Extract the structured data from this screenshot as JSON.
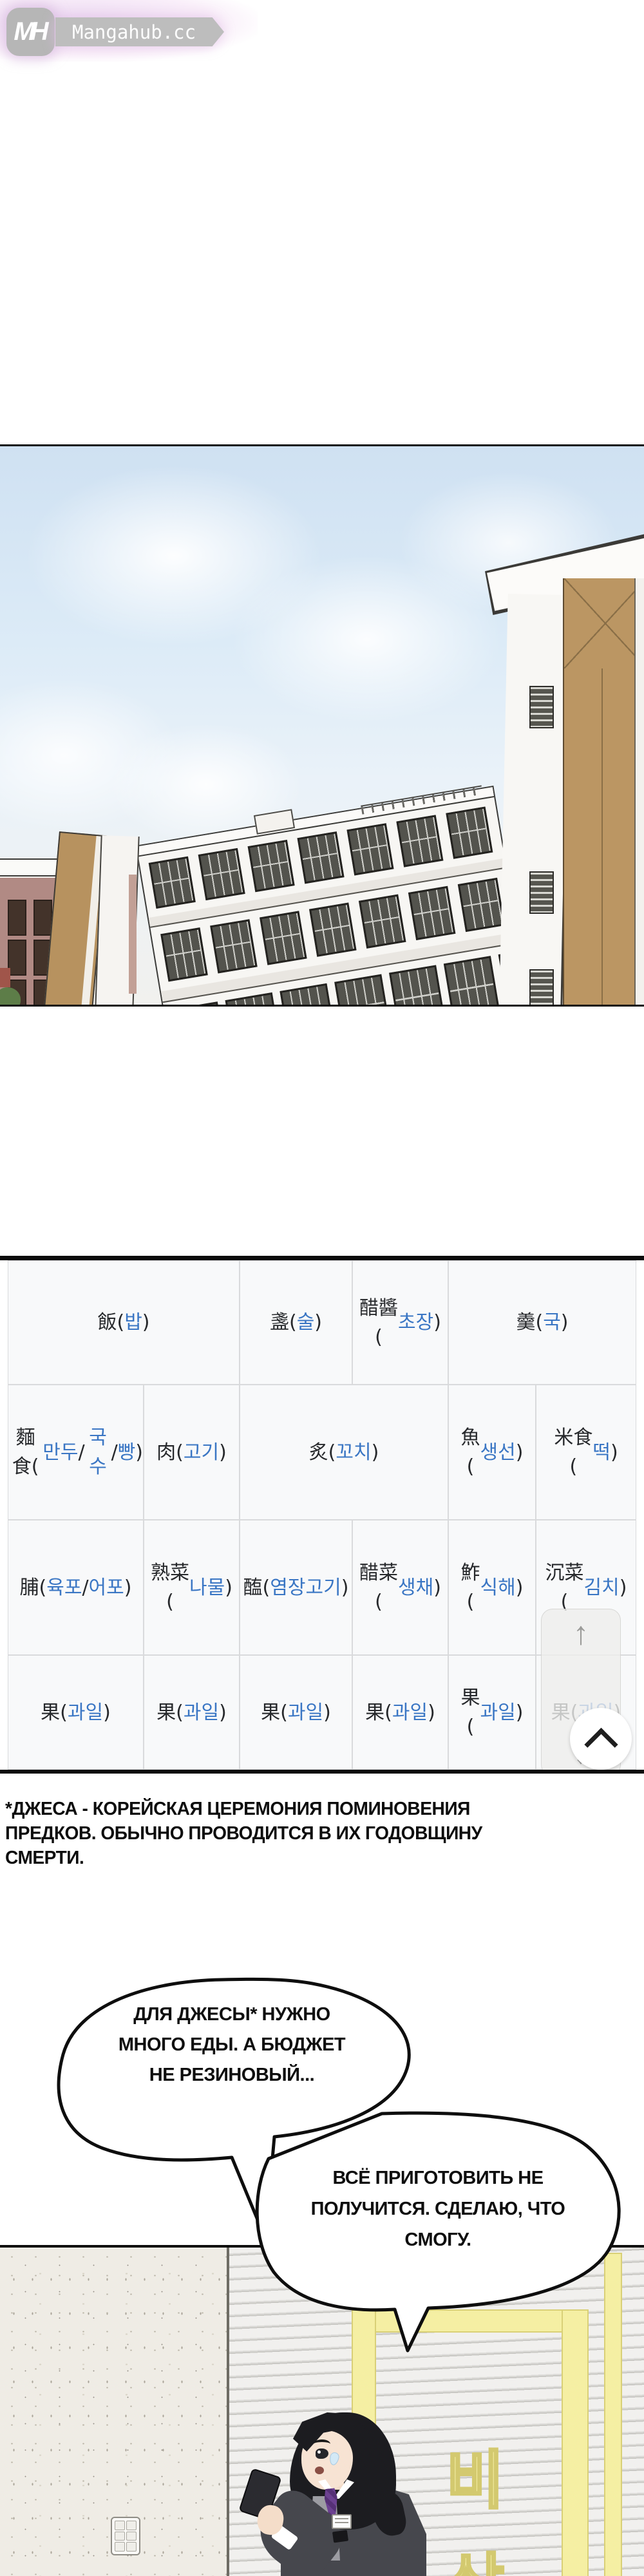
{
  "watermark": {
    "logo_text": "MH",
    "site_name": "Mangahub.cc"
  },
  "table": {
    "hanja_color": "#26282b",
    "hangul_color": "#3a76c4",
    "background": "#f8f9fa",
    "rows": [
      {
        "cells": [
          {
            "text": "飯(밥)",
            "col": 0,
            "span": 2
          },
          {
            "text": "盞(술)",
            "col": 2,
            "span": 1
          },
          {
            "text": "醋醬\n(초\n장)",
            "col": 3,
            "span": 1
          },
          {
            "text": "羹(국)",
            "col": 4,
            "span": 2
          }
        ]
      },
      {
        "cells": [
          {
            "text": "麵食(만\n두/국수/\n빵)",
            "col": 0,
            "span": 1
          },
          {
            "text": "肉(고\n기)",
            "col": 1,
            "span": 1
          },
          {
            "text": "炙(꼬치)",
            "col": 2,
            "span": 2
          },
          {
            "text": "魚\n(생\n선)",
            "col": 4,
            "span": 1
          },
          {
            "text": "米食\n(떡)",
            "col": 5,
            "span": 1
          }
        ]
      },
      {
        "cells": [
          {
            "text": "脯(육포/\n어포)",
            "col": 0,
            "span": 1
          },
          {
            "text": "熟菜\n(나\n물)",
            "col": 1,
            "span": 1
          },
          {
            "text": "醢(염\n장고\n기)",
            "col": 2,
            "span": 1
          },
          {
            "text": "醋菜\n(생\n채)",
            "col": 3,
            "span": 1
          },
          {
            "text": "鮓\n(식\n해)",
            "col": 4,
            "span": 1
          },
          {
            "text": "沉菜\n(김치)",
            "col": 5,
            "span": 1
          }
        ]
      },
      {
        "cells": [
          {
            "text": "果(과일)",
            "col": 0,
            "span": 1
          },
          {
            "text": "果(과\n일)",
            "col": 1,
            "span": 1
          },
          {
            "text": "果(과\n일)",
            "col": 2,
            "span": 1
          },
          {
            "text": "果(과\n일)",
            "col": 3,
            "span": 1
          },
          {
            "text": "果\n(과\n일)",
            "col": 4,
            "span": 1
          },
          {
            "text": "果(과\n일)",
            "col": 5,
            "span": 1
          }
        ]
      }
    ]
  },
  "scroll_ui": {
    "up_arrow": "↑",
    "down_arrow": "↓"
  },
  "footnote": {
    "lines": [
      "*ДЖЕСА - КОРЕЙСКАЯ ЦЕРЕМОНИЯ ПОМИНОВЕНИЯ",
      "ПРЕДКОВ. ОБЫЧНО ПРОВОДИТСЯ В ИХ ГОДОВЩИНУ",
      "СМЕРТИ."
    ]
  },
  "bubbles": [
    {
      "lines": [
        "ДЛЯ ДЖЕСЫ* НУЖНО",
        "МНОГО ЕДЫ. А БЮДЖЕТ",
        "НЕ РЕЗИНОВЫЙ..."
      ]
    },
    {
      "lines": [
        "ВСЁ ПРИГОТОВИТЬ НЕ",
        "ПОЛУЧИТСЯ. СДЕЛАЮ, ЧТО",
        "СМОГУ."
      ]
    }
  ],
  "sign": {
    "chars": [
      "비",
      "상"
    ],
    "color": "#f5efa5"
  },
  "colors": {
    "sky_top": "#cfe1f2",
    "building_tan": "#bb9663",
    "yellow_frame": "#f5efa3",
    "panel_border": "#0a0a0a"
  }
}
